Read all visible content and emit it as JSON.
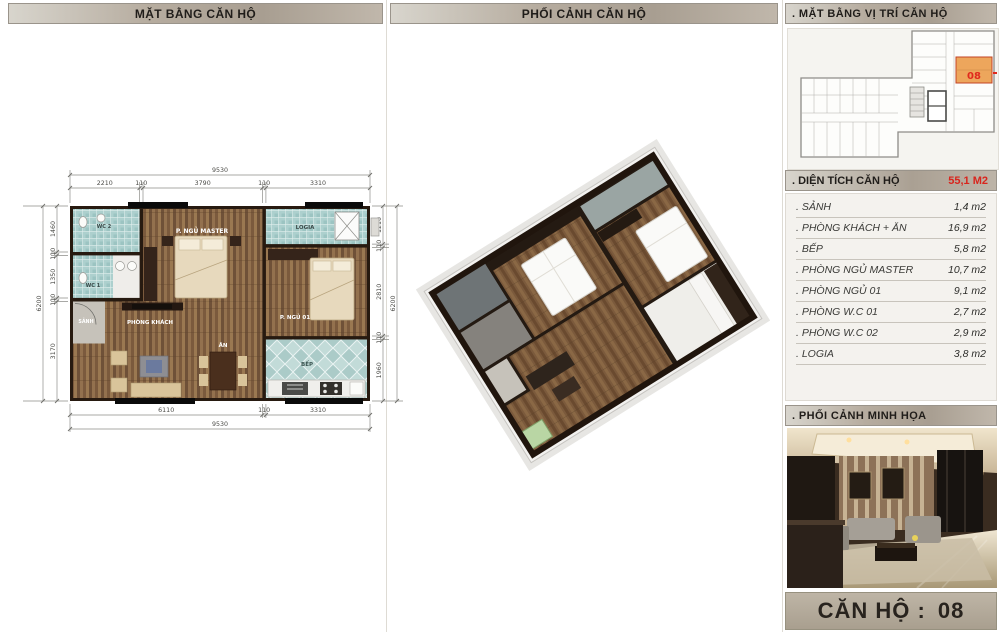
{
  "panels": {
    "floor_plan_title": "MẶT BẰNG CĂN HỘ",
    "perspective_title": "PHỐI CẢNH CĂN HỘ",
    "location_title": ". MẶT BẰNG VỊ TRÍ CĂN HỘ",
    "area_title": ". DIỆN TÍCH CĂN HỘ",
    "area_total": "55,1 M2",
    "illustration_title": ". PHỐI CẢNH MINH HỌA"
  },
  "unit_bar": {
    "label": "CĂN HỘ :",
    "number": "08"
  },
  "keyplan": {
    "unit_number": "08"
  },
  "floor_plan": {
    "rooms": {
      "wc2": "WC 2",
      "wc1": "WC 1",
      "master": "P. NGỦ MASTER",
      "logia": "LOGIA",
      "sanh": "SẢNH",
      "khach": "PHÒNG KHÁCH",
      "ngu01": "P. NGỦ 01",
      "an": "ĂN",
      "bep": "BẾP"
    },
    "dims": {
      "top_total": "9530",
      "top": [
        "2210",
        "110",
        "3790",
        "110",
        "3310"
      ],
      "left_total": "6200",
      "left": [
        "1460",
        "110",
        "1350",
        "110",
        "3170"
      ],
      "right_total": "6200",
      "right": [
        "1210",
        "110",
        "2810",
        "110",
        "1960"
      ],
      "bottom": [
        "6110",
        "110",
        "3310"
      ],
      "bottom_total": "9530"
    }
  },
  "area_table": {
    "rows": [
      {
        "label": ". SẢNH",
        "value": "1,4 m2"
      },
      {
        "label": ". PHÒNG KHÁCH + ĂN",
        "value": "16,9 m2"
      },
      {
        "label": ". BẾP",
        "value": "5,8 m2"
      },
      {
        "label": ". PHÒNG NGỦ MASTER",
        "value": "10,7 m2"
      },
      {
        "label": ". PHÒNG NGỦ 01",
        "value": "9,1 m2"
      },
      {
        "label": ". PHÒNG W.C 01",
        "value": "2,7 m2"
      },
      {
        "label": ". PHÒNG W.C 02",
        "value": "2,9 m2"
      },
      {
        "label": ". LOGIA",
        "value": "3,8 m2"
      }
    ]
  },
  "colors": {
    "accent_red": "#d9251d",
    "unit_highlight": "#eda65c",
    "header_tan": "#aa9f92",
    "tile_teal": "#a9cdcb",
    "wood_brown": "#8a6743"
  }
}
